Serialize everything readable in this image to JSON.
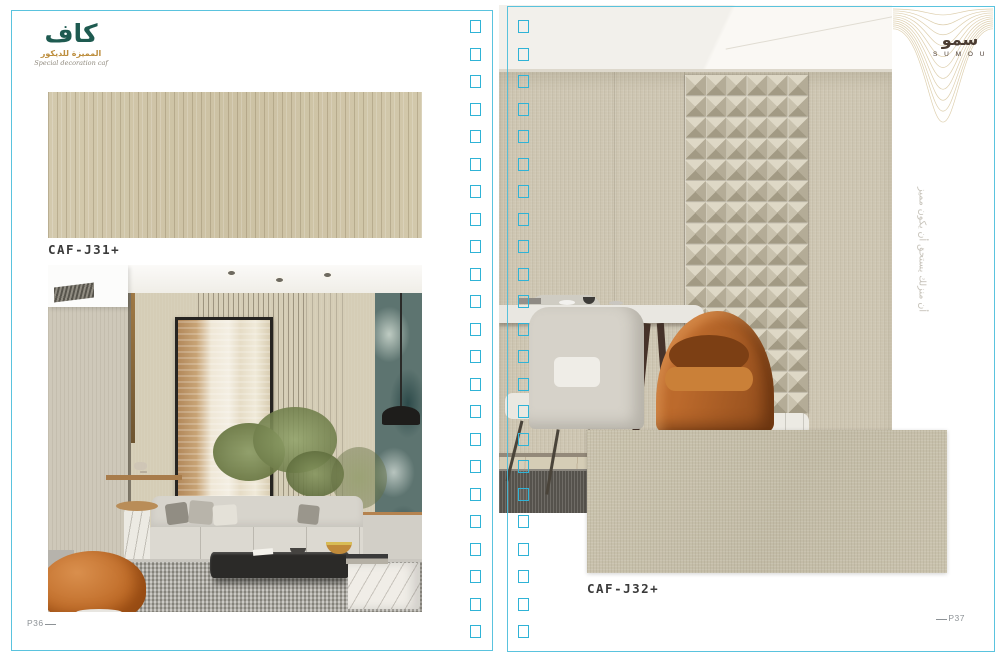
{
  "brand_left": {
    "logo_arabic": "كاف",
    "subtitle_arabic": "المميزة للديكور",
    "subtitle_english": "Special decoration caf"
  },
  "brand_right": {
    "logo_arabic": "سمو",
    "logo_english": "S U M O U",
    "vertical_tagline_arabic": "أن منزلك يستحق أن يكون مميز"
  },
  "left_page": {
    "swatch_label": "CAF-J31+",
    "page_number": "P36"
  },
  "right_page": {
    "swatch_label": "CAF-J32+",
    "page_number": "P37"
  },
  "decor": {
    "binding_hole_columns": 2,
    "binding_hole_count": 23,
    "accent_cyan": "#2fb3d6",
    "swatch_j31_color": "#cfc4a7",
    "swatch_j32_color": "#c6bfaa",
    "kaf_teal": "#1e5a50",
    "kaf_gold": "#bd8e3e",
    "sumou_brown": "#4a3b31",
    "wave_gold": "#d8c7a0",
    "label_color": "#3b3b3b",
    "page_number_color": "#8d9296"
  }
}
